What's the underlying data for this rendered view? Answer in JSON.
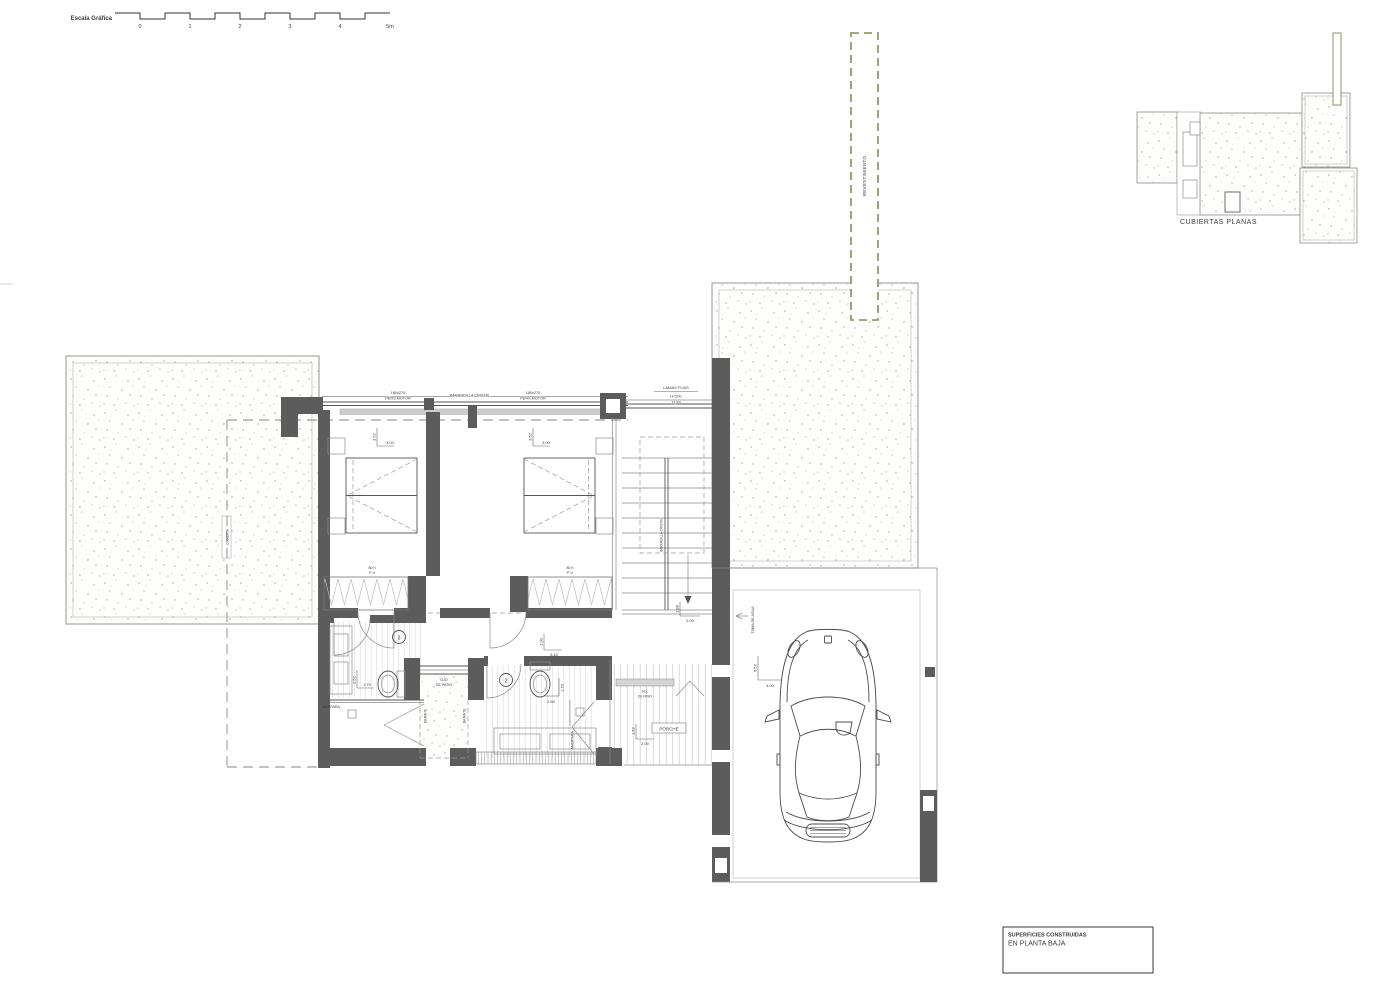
{
  "colors": {
    "wall": "#5c5c5c",
    "facade_dash": "#8a8a54",
    "line": "#555555"
  },
  "scale_bar": {
    "label": "Escala Gráfica",
    "ticks": [
      "0",
      "1",
      "2",
      "3",
      "4",
      "5m"
    ]
  },
  "key_plan": {
    "title": "CUBIERTAS PLANAS"
  },
  "facade": {
    "label": "REVESTIMIENTO"
  },
  "window_band": {
    "left_size": "180x270",
    "left_type": "PERS.MOTOR",
    "railing": "BARANDILLA CRISTAL",
    "right_size": "180x270",
    "right_type": "PERS.MOTOR"
  },
  "lamas": {
    "title": "LAMAS FIJAS",
    "height": "H=200",
    "dim": "11,83"
  },
  "bedroom1": {
    "dim_depth": "3.52",
    "dim_width": "3.00",
    "closet_line1": "80 h",
    "closet_line2": "P-V"
  },
  "bedroom2": {
    "dim_depth": "3.52",
    "dim_width": "3.00",
    "closet_line1": "80 h",
    "closet_line2": "P-V"
  },
  "stairs": {
    "railing": "BARANDILLA CRISTAL",
    "dim_v": "1.88",
    "dim_h": "2.00"
  },
  "hall": {
    "dim_v": "1.00",
    "dim_h": "3.10"
  },
  "bath3": {
    "number": "3",
    "dim_v": "2.52",
    "dim_h": "1.70",
    "screen": "MAMPARA"
  },
  "bath2": {
    "number": "2",
    "dim_v": "1.70",
    "dim_h": "2.60",
    "screen": "MAMPARA"
  },
  "shaft": {
    "label_line1": "OJO",
    "label_line2": "DE PATIO",
    "side_left": "BAJANTE",
    "side_right": "BAJANTE"
  },
  "porch": {
    "name": "PORCHE",
    "dim_v": "1.52",
    "dim_h": "2.00",
    "door_line1": "PTA.",
    "door_line2": "DE PASO"
  },
  "garage": {
    "water_label": "TOMA DE AGUA",
    "dim_v": "6.52",
    "dim_h": "4.00"
  },
  "terrace_left": {
    "tag": "CUBIERTA"
  },
  "title_block": {
    "line1": "SUPERFICIES CONSTRUIDAS",
    "line2": "EN PLANTA BAJA"
  }
}
